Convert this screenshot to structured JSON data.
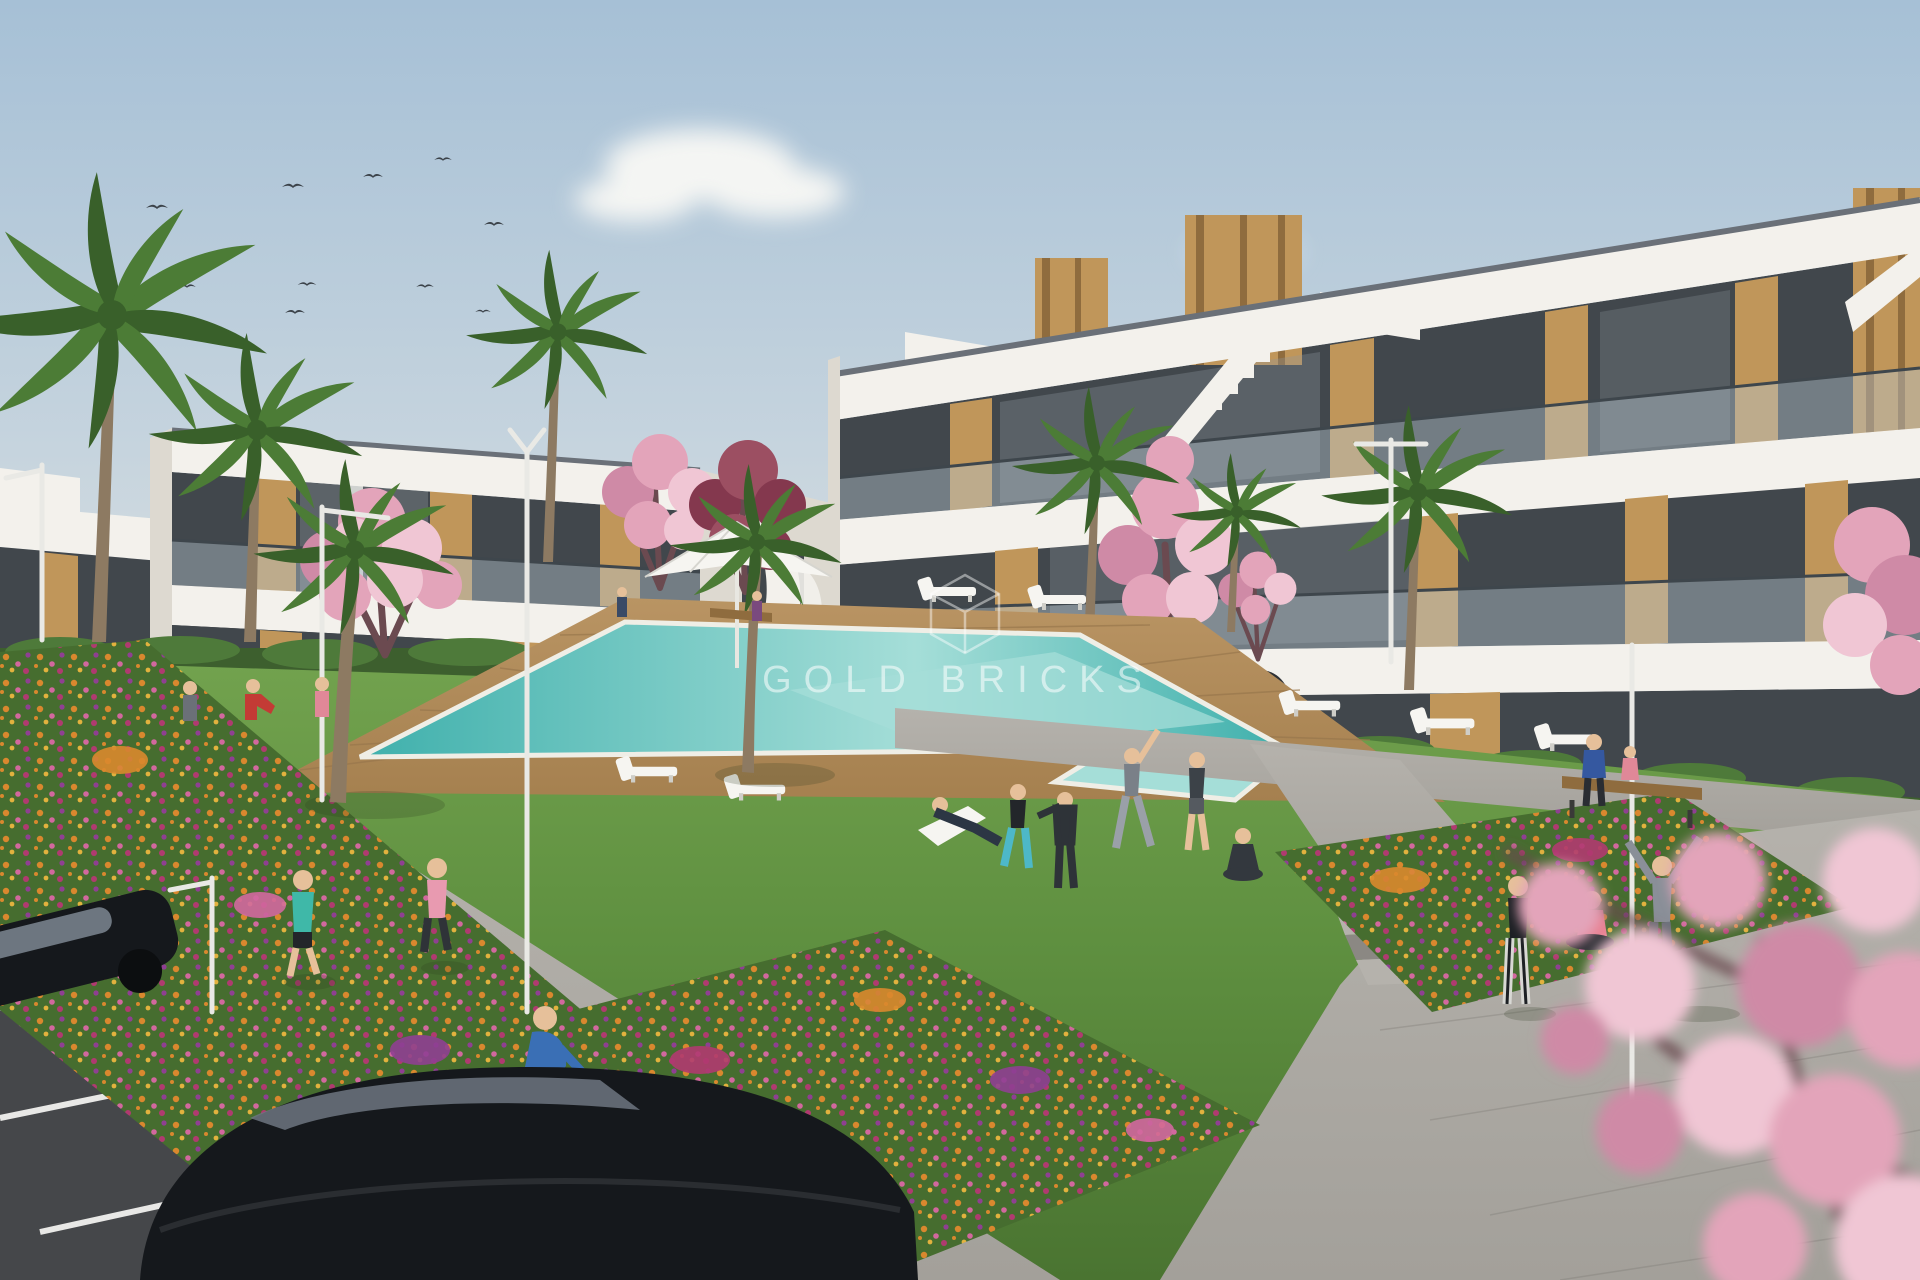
{
  "watermark": {
    "text": "GOLD BRICKS",
    "logo": "hexagon-gem-outline-icon"
  },
  "scene": {
    "type": "architectural-render",
    "objects": [
      "modern white apartment buildings with wood cladding and glass balconies",
      "communal swimming pool with wooden deck",
      "white sun loungers and parasol",
      "central lawn with exercise group and yoga",
      "flower beds with orange pink and purple flowers",
      "palm trees and pink cherry-blossom trees",
      "street lamps",
      "two joggers on sidewalk",
      "cyclist on paved path",
      "couple on wooden bench",
      "three people on right plaza",
      "two black parked cars on asphalt road",
      "flock of birds in sky",
      "soft clouds"
    ]
  },
  "palette": {
    "sky_top": "#a6c0d6",
    "sky_mid": "#c6d4de",
    "sky_horizon": "#e7e8e4",
    "cloud": "#f4f5f3",
    "bird": "#3c434a",
    "wall_white": "#f3f1ec",
    "wall_shade": "#ddd9d0",
    "wall_dark": "#c9c4ba",
    "roof_line": "#6a7078",
    "glass_dark": "#41474c",
    "glass_light": "#8e979e",
    "balustrade": "#b9c9d1",
    "rail": "#3e464c",
    "wood": "#c0965a",
    "wood_dark": "#8f6c3e",
    "hedge": "#3d5f2e",
    "hedge_light": "#4e7a3a",
    "grass": "#5f9040",
    "grass_light": "#72a24e",
    "grass_dark": "#4a7431",
    "bed_green": "#466d2f",
    "flower_orange": "#d9882e",
    "flower_pink": "#d2689e",
    "flower_purple": "#8f3f92",
    "flower_yellow": "#e2b23e",
    "flower_magenta": "#b03a70",
    "deck": "#b99463",
    "deck_line": "#97764c",
    "pool_deep": "#3fb0ac",
    "pool_light": "#a5ded8",
    "pool_rim": "#efeee6",
    "path": "#a3a09a",
    "path_light": "#b5b2ac",
    "path_dark": "#8b8883",
    "asphalt": "#45474a",
    "road_line": "#e8e8e6",
    "car": "#15181c",
    "car_glass": "#6d7680",
    "lamp": "#e9e9e5",
    "trunk": "#8d7a62",
    "palm": "#4c7c36",
    "palm_dark": "#39602a",
    "blossom": "#e3a4ba",
    "blossom_light": "#f0c6d4",
    "blossom_deep": "#cf8aa6",
    "branch": "#6b4a50",
    "crimson": "#84384e",
    "crimson_light": "#9c4f62",
    "skin": "#e6c09a",
    "watermark": "rgba(255,255,255,0.55)"
  }
}
